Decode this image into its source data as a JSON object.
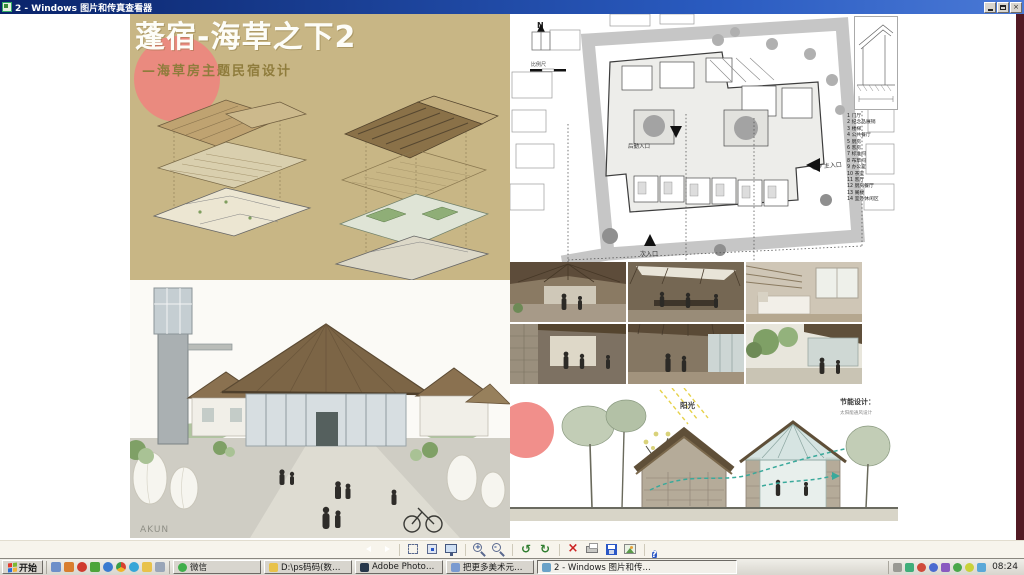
{
  "window": {
    "title": "2 - Windows 图片和传真查看器"
  },
  "colors": {
    "titlebar_blue": "#0a246a",
    "poster_tan": "#c8b685",
    "accent_red": "#f0837e",
    "teal_flow": "#3aa99b",
    "image_edge_strip": "#521a24"
  },
  "poster": {
    "title": "蓬宿-海草之下2",
    "subtitle": "—海草房主题民宿设计",
    "watermark": "AKUN",
    "site_plan": {
      "north_label": "N",
      "scale_label": "比例尺",
      "entrance_main": "主入口",
      "entrance_secondary": "次入口",
      "entrance_service": "后勤入口",
      "legend": [
        "1  门厅",
        "2  纪念品展销",
        "3  楼梯",
        "4  公共餐厅",
        "5  厨房",
        "6  客房",
        "7  标准间",
        "8  布草间",
        "9  办公室",
        "10 茶室",
        "11 客厅",
        "12 厨房餐厅",
        "13 阁楼",
        "14 室外休闲区"
      ]
    },
    "elevation": {
      "sun_label": "阳光",
      "energy_title": "节能设计：",
      "energy_sub": "太阳能通风设计"
    }
  },
  "viewer_toolbar": {
    "buttons": [
      "previous-image",
      "next-image",
      "best-fit",
      "actual-size",
      "slideshow",
      "zoom-in",
      "zoom-out",
      "rotate-counterclockwise",
      "rotate-clockwise",
      "delete",
      "print",
      "save",
      "edit",
      "help"
    ]
  },
  "taskbar": {
    "start_label": "开始",
    "quick_launch_icons": [
      "show-desktop-icon",
      "media-player-icon",
      "qq-icon",
      "msn-icon",
      "browser-icon",
      "chrome-icon",
      "skype-icon",
      "folder-icon",
      "notes-icon"
    ],
    "tasks": [
      {
        "label": "微信"
      },
      {
        "label": "D:\\ps码码(数学)\\学生..."
      },
      {
        "label": "Adobe Photoshop"
      },
      {
        "label": "把更多美术元素(自动..."
      },
      {
        "label": "2 - Windows 图片和传...",
        "active": true
      }
    ],
    "tray_icons": [
      "printer-icon",
      "safely-remove-icon",
      "network-icon",
      "qq-tray-icon",
      "im-tray-icon",
      "volume-icon",
      "antivirus-icon",
      "input-method-icon"
    ],
    "clock": "08:24"
  }
}
